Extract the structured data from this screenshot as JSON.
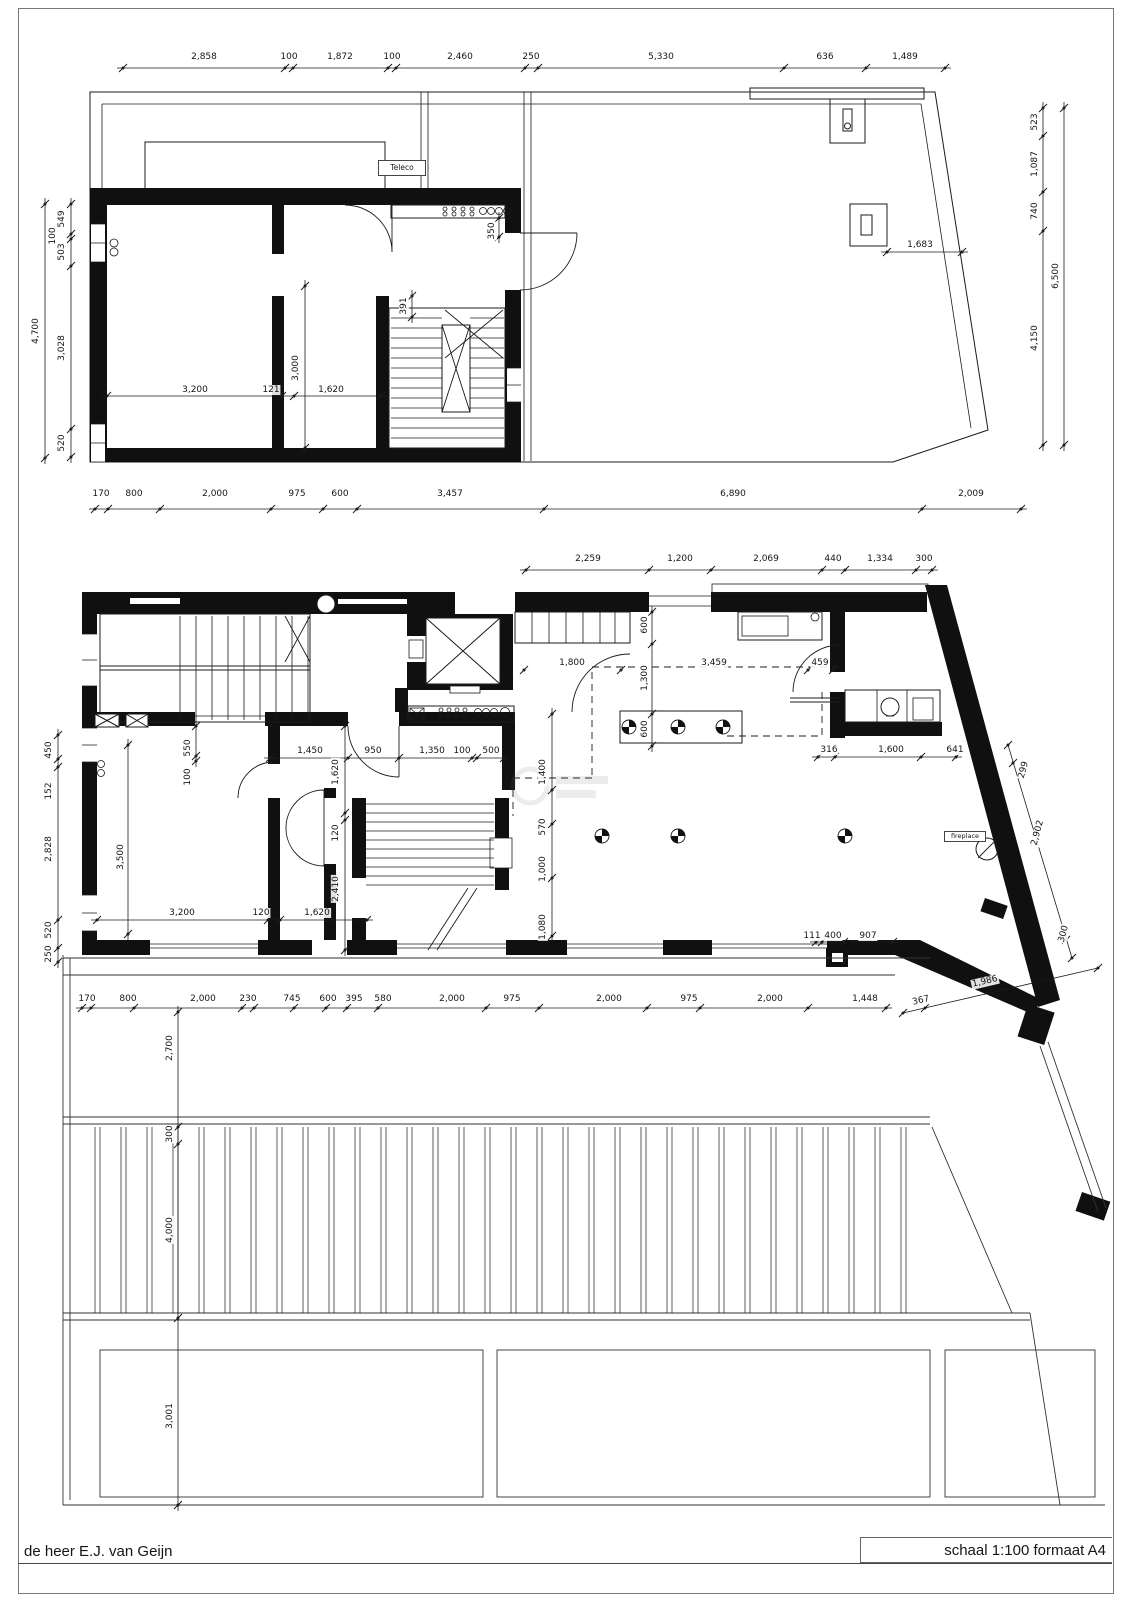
{
  "upper": {
    "top": [
      "2,858",
      "100",
      "1,872",
      "100",
      "2,460",
      "250",
      "5,330",
      "636",
      "1,489"
    ],
    "bottom": [
      "170",
      "800",
      "2,000",
      "975",
      "600",
      "3,457",
      "6,890",
      "2,009"
    ],
    "left_total": "4,700",
    "left": [
      "549",
      "100",
      "503",
      "3,028",
      "520"
    ],
    "right": [
      "523",
      "1,087",
      "740",
      "4,150"
    ],
    "right_total": "6,500",
    "interior": [
      "3,200",
      "121",
      "3,000",
      "1,620",
      "350",
      "391",
      "1,683"
    ],
    "teleco": "Teleco"
  },
  "lower": {
    "top": [
      "2,259",
      "1,200",
      "2,069",
      "440",
      "1,334",
      "300"
    ],
    "bottom": [
      "170",
      "800",
      "2,000",
      "230",
      "745",
      "600",
      "395",
      "580",
      "2,000",
      "975",
      "2,000",
      "975",
      "2,000",
      "1,448"
    ],
    "bottom_diag": [
      "367",
      "1,986"
    ],
    "left": [
      "450",
      "152",
      "2,828",
      "520",
      "250"
    ],
    "room_h": [
      "1,450",
      "950",
      "1,350",
      "100",
      "500"
    ],
    "room_h2": [
      "3,200",
      "120",
      "1,620"
    ],
    "room_v": [
      "550",
      "100"
    ],
    "door_v": [
      "1,620",
      "120",
      "2,410"
    ],
    "room_height": "3,500",
    "shaft_v": [
      "600",
      "1,300",
      "600"
    ],
    "corridor": [
      "1,800",
      "3,459",
      "459"
    ],
    "wc": [
      "316",
      "1,600",
      "641"
    ],
    "mid_v": [
      "1,400",
      "570",
      "1,000",
      "1,080"
    ],
    "col": [
      "111",
      "400",
      "907"
    ],
    "slant": [
      "299",
      "2,902",
      "300"
    ],
    "site_v": [
      "2,700",
      "300",
      "4,000",
      "3,001"
    ],
    "fireplace": "fireplace"
  },
  "footer": {
    "client": "de heer E.J. van Geijn",
    "scale": "schaal 1:100  formaat A4"
  }
}
